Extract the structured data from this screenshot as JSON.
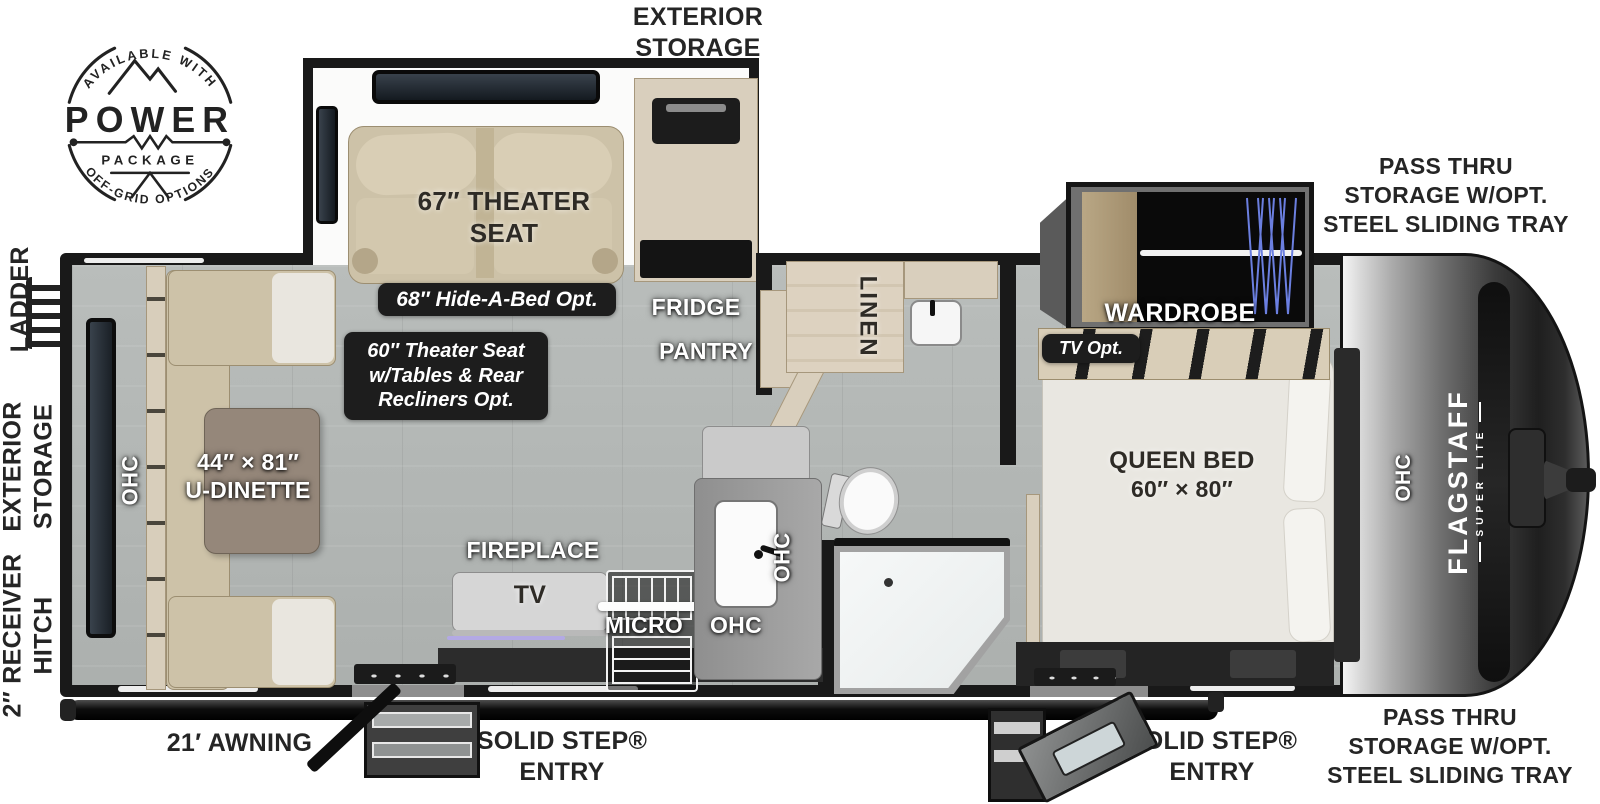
{
  "badge": {
    "arc_top": "AVAILABLE WITH",
    "title": "POWER",
    "subtitle": "PACKAGE",
    "arc_bottom": "OFF-GRID OPTIONS"
  },
  "exterior": {
    "top_storage": "EXTERIOR STORAGE",
    "pass_thru_top": [
      "PASS THRU",
      "STORAGE W/OPT.",
      "STEEL SLIDING TRAY"
    ],
    "pass_thru_bottom": [
      "PASS THRU",
      "STORAGE W/OPT.",
      "STEEL SLIDING TRAY"
    ],
    "awning": "21′ AWNING",
    "entry_main": [
      "SOLID STEP®",
      "ENTRY"
    ],
    "entry_bedroom": [
      "SOLID STEP®",
      "ENTRY"
    ],
    "ladder": "LADDER",
    "side_storage": "EXTERIOR STORAGE",
    "hitch": "2″ RECEIVER HITCH"
  },
  "interior": {
    "theater_seat": [
      "67″ THEATER",
      "SEAT"
    ],
    "hide_a_bed_opt": "68″ Hide-A-Bed Opt.",
    "theater_opt": [
      "60″ Theater Seat",
      "w/Tables & Rear",
      "Recliners Opt."
    ],
    "fridge": "FRIDGE",
    "pantry": "PANTRY",
    "linen": "LINEN",
    "wardrobe": "WARDROBE",
    "tv_opt": "TV Opt.",
    "queen_bed": [
      "QUEEN BED",
      "60″ × 80″"
    ],
    "u_dinette": [
      "44″ × 81″",
      "U-DINETTE"
    ],
    "fireplace": "FIREPLACE",
    "tv": "TV",
    "micro": "MICRO",
    "ohc_dinette": "OHC",
    "ohc_kitchen_wall": "OHC",
    "ohc_kitchen": "OHC",
    "ohc_bedroom": "OHC"
  },
  "brand": {
    "name": "FLAGSTAFF",
    "series": "SUPER LITE"
  }
}
